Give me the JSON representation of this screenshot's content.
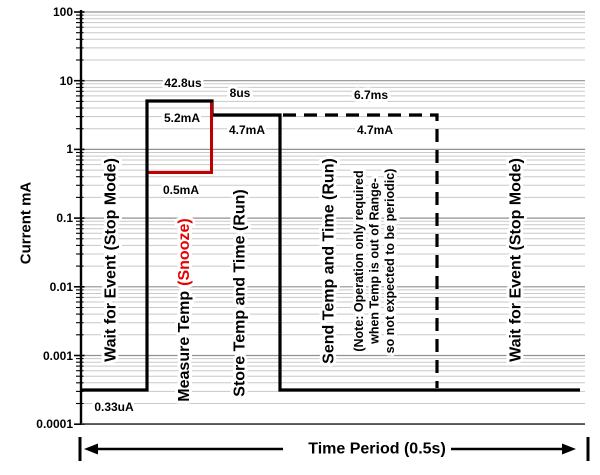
{
  "chart_data": {
    "type": "line",
    "title": "",
    "ylabel": "Current mA",
    "xlabel": "Time Period (0.5s)",
    "y_scale": "log",
    "ylim": [
      0.0001,
      100
    ],
    "y_tick_labels": [
      "100",
      "10",
      "1",
      "0.1",
      "0.01",
      "0.001",
      "0.0001"
    ],
    "grid": "horizontal log major and minor gridlines",
    "legend": "none",
    "time_period": {
      "label": "Time Period (0.5s)",
      "seconds": 0.5
    },
    "phases": [
      {
        "name": "Wait for Event (Stop Mode)",
        "current_mA": 0.00033,
        "current_label": "0.33uA",
        "line_style": "solid"
      },
      {
        "name": "Measure Temp (Snooze)",
        "name_black": "Measure Temp",
        "name_red": "(Snooze)",
        "duration_label": "42.8us",
        "run_current_mA": 5.2,
        "run_current_label": "5.2mA",
        "snooze_current_mA": 0.5,
        "snooze_current_label": "0.5mA",
        "line_style": "solid"
      },
      {
        "name": "Store Temp and Time (Run)",
        "duration_label": "8us",
        "current_mA": 4.7,
        "current_label": "4.7mA",
        "line_style": "solid"
      },
      {
        "name": "Send Temp and Time (Run)",
        "duration_label": "6.7ms",
        "current_mA": 4.7,
        "current_label": "4.7mA",
        "line_style": "dashed",
        "note_lines": [
          "(Note: Operation only required",
          "when Temp  is out of Range-",
          "so not expected to be periodic)"
        ]
      },
      {
        "name": "Wait for Event (Stop Mode)",
        "current_mA": 0.00033,
        "line_style": "solid"
      }
    ],
    "colors": {
      "trace": "#000000",
      "snooze_line": "#c00000",
      "snooze_text": "#e60000",
      "grid_minor": "#c8c8c8",
      "grid_major": "#909090",
      "axis": "#000000"
    }
  }
}
